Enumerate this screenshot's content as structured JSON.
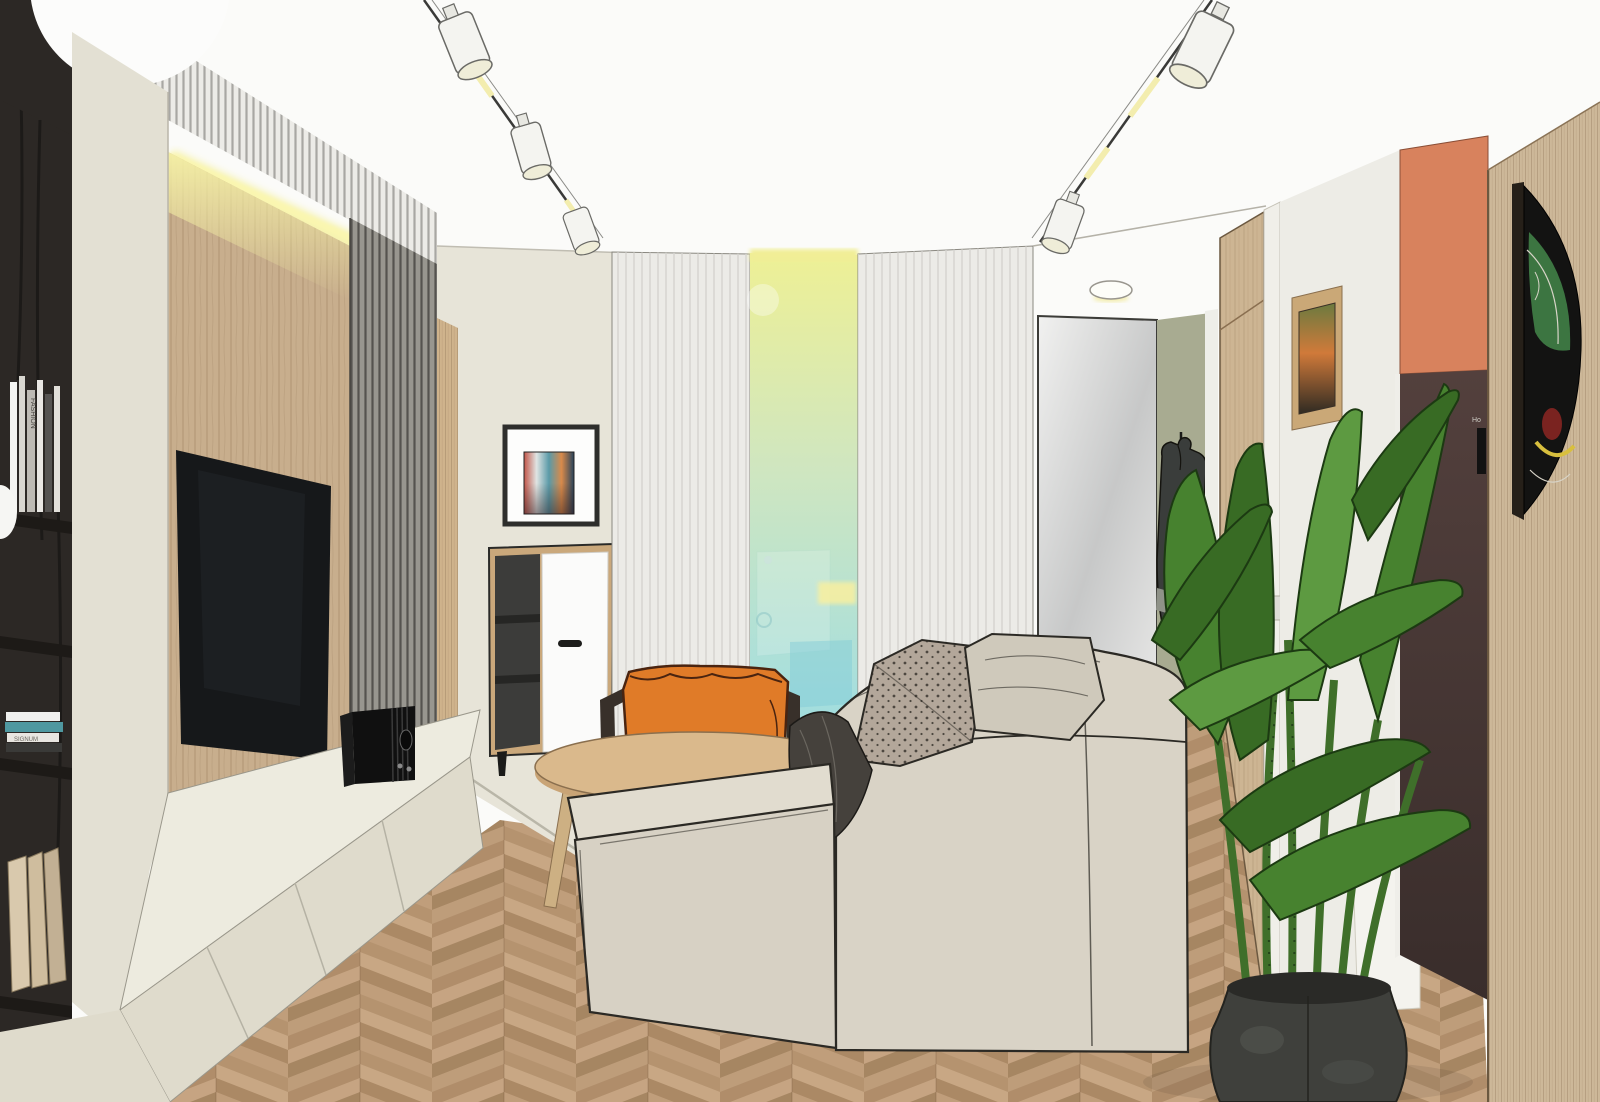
{
  "meta": {
    "title": "Living room interior 3D sketch rendering",
    "style": "SketchUp-style architectural visualization",
    "canvas": {
      "width": 1600,
      "height": 1102
    }
  },
  "texts": {
    "book_spine": "FASHION",
    "book_stack": "SIGNUM",
    "fridge_label": "Ho"
  },
  "palette": {
    "bg": "#fbfbf9",
    "outline": "#2b2924",
    "floor_base": "#c2a17e",
    "bookshelf": "#2c2825",
    "shelf_board": "#1d1a17",
    "divider": "#e3e0d3",
    "crown": "#ecebe7",
    "led": "#f6f2a6",
    "wood_wall": "#c8ae8d",
    "slat_grey": "#98968f",
    "trim_wood": "#cfb38c",
    "wall_cream": "#e7e4d8",
    "tv": "#16181a",
    "bench_top": "#edebdf",
    "bench_front": "#dfdbcc",
    "radio": "#101010",
    "art_frame": "#2e2e2c",
    "cabinet_wood": "#caa87b",
    "cabinet_dark": "#3c3c3a",
    "cabinet_door": "#fbfbfa",
    "glass_top": "#eef095",
    "glass_mid": "#cfe6c0",
    "glass_low": "#a8dfdc",
    "glass_bottom": "#85d2e4",
    "mirror_hi": "#f1f1f0",
    "mirror_lo": "#c7c8c8",
    "sage_wall": "#a8ab91",
    "jacket": "#3a3d3b",
    "door_wood": "#cdb593",
    "trim_white": "#f0efe9",
    "hall_wall": "#edece6",
    "pic_frame": "#caa877",
    "coral_wall": "#d8825d",
    "fridge_hi": "#53403d",
    "fridge_lo": "#392d2b",
    "wood_panel": "#cdb899",
    "mask_black": "#131312",
    "mask_green": "#3e7a44",
    "mask_red": "#7a2320",
    "mask_yellow": "#d8bf3e",
    "sofa": "#d9d3c6",
    "sofa_top": "#e1dccf",
    "sofa_front": "#d7d1c4",
    "pillow_dots": "#b3a79a",
    "pillow_beige": "#cfc9bb",
    "blanket": "#45413c",
    "chair_orange": "#e07b28",
    "chair_frame": "#38302a",
    "chair_seat": "#a09c94",
    "stool": "#1f1f1f",
    "table_top": "#dab98c",
    "table_edge": "#c9a476",
    "table_leg": "#cdb083",
    "rug": "#b7b4ac",
    "leaf_main": "#47822f",
    "leaf_dark": "#386b24",
    "leaf_light": "#5d9a41",
    "stem": "#3f6f2a",
    "pot": "#3f403c",
    "pot_light": "#565752",
    "light_warm": "#f3edae",
    "spot_white": "#f4f4f0"
  }
}
